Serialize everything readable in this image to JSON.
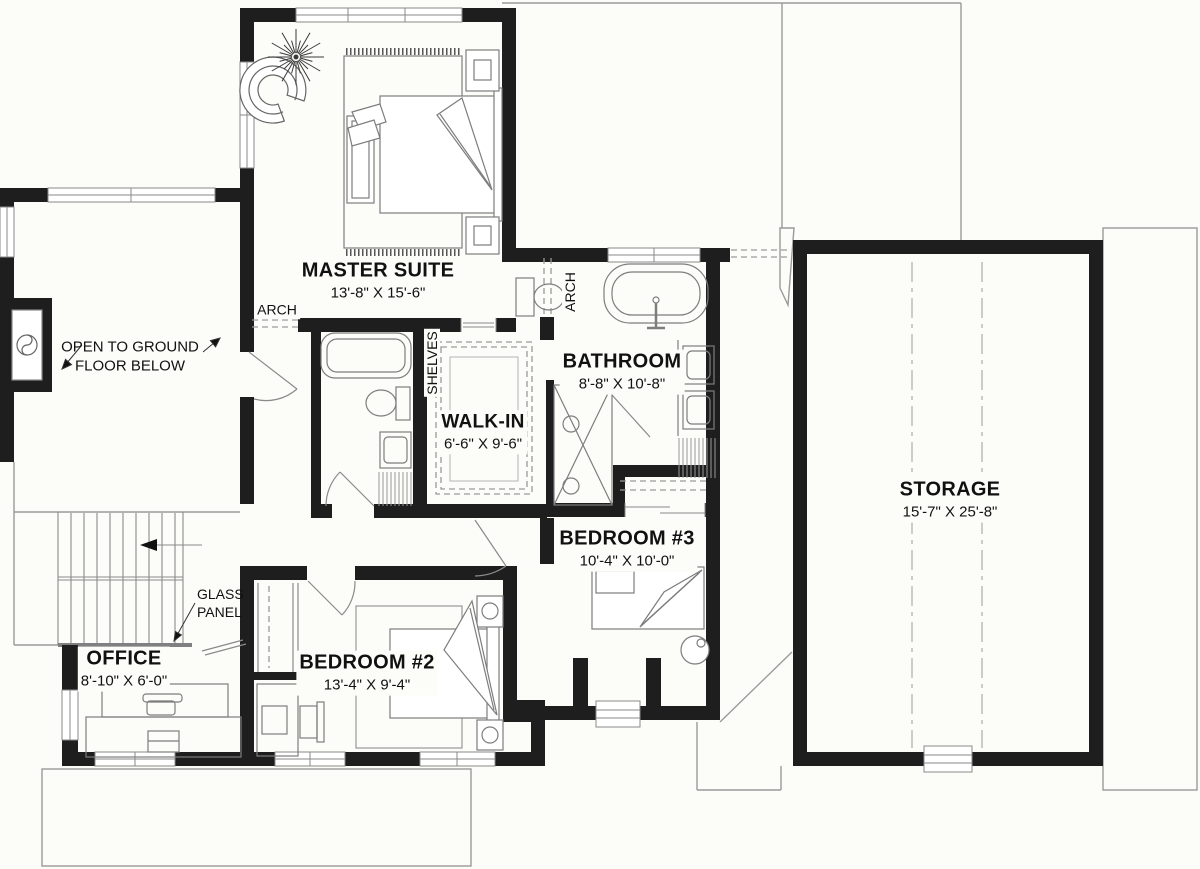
{
  "rooms": {
    "master": {
      "name": "MASTER SUITE",
      "dims": "13'-8\" X 15'-6\""
    },
    "bathroom": {
      "name": "BATHROOM",
      "dims": "8'-8\" X 10'-8\""
    },
    "walkin": {
      "name": "WALK-IN",
      "dims": "6'-6\" X 9'-6\""
    },
    "bedroom3": {
      "name": "BEDROOM #3",
      "dims": "10'-4\" X 10'-0\""
    },
    "bedroom2": {
      "name": "BEDROOM #2",
      "dims": "13'-4\" X 9'-4\""
    },
    "office": {
      "name": "OFFICE",
      "dims": "8'-10\" X 6'-0\""
    },
    "storage": {
      "name": "STORAGE",
      "dims": "15'-7\" X 25'-8\""
    }
  },
  "annotations": {
    "open_below_line1": "OPEN TO GROUND",
    "open_below_line2": "FLOOR BELOW",
    "arch_left": "ARCH",
    "arch_bath": "ARCH",
    "shelves": "SHELVES",
    "glass_line1": "GLASS",
    "glass_line2": "PANEL"
  },
  "colors": {
    "wall": "#1e1e1e",
    "furniture_line": "#7d7d7d",
    "dash_line": "#9a9a9a",
    "background": "#fcfcf8",
    "text": "#111111"
  }
}
